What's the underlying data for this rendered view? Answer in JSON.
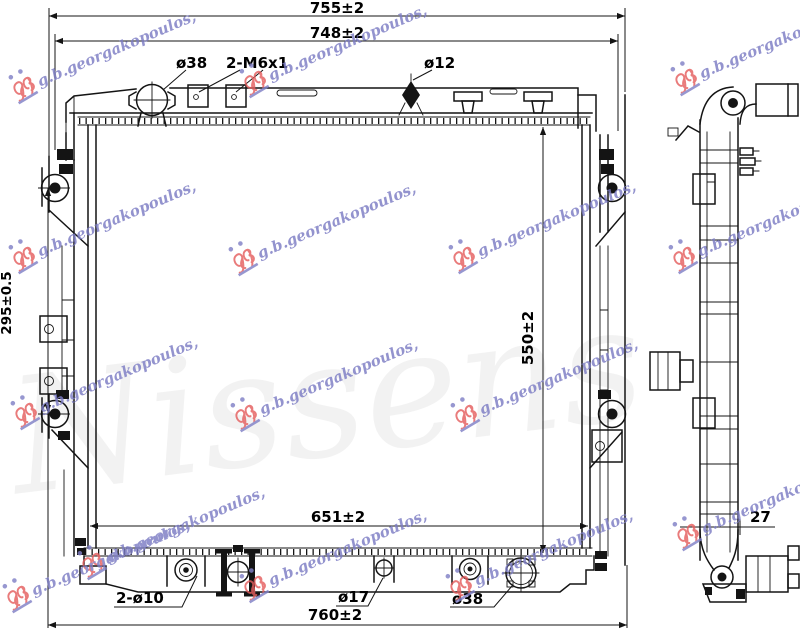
{
  "drawing": {
    "ghost_watermark": "Nissens",
    "watermark": "g.b.georgakopoulos,",
    "colors": {
      "line": "#141414",
      "watermark_blue": "#7c7cc4",
      "watermark_red": "#e55f5f"
    },
    "front": {
      "dim_overall_width": "755±2",
      "dim_tank_width": "748±2",
      "dim_pin_span": "295±0.5",
      "dim_core_height": "550±2",
      "dim_core_width": "651±2",
      "dim_bottom_width": "760±2",
      "label_inlet": "ø38",
      "label_bolts": "2-M6x1",
      "label_overflow": "ø12",
      "label_bottom_pins": "2-ø10",
      "label_center_pin": "ø17",
      "label_outlet": "ø38"
    },
    "side": {
      "dim_depth": "27"
    }
  }
}
